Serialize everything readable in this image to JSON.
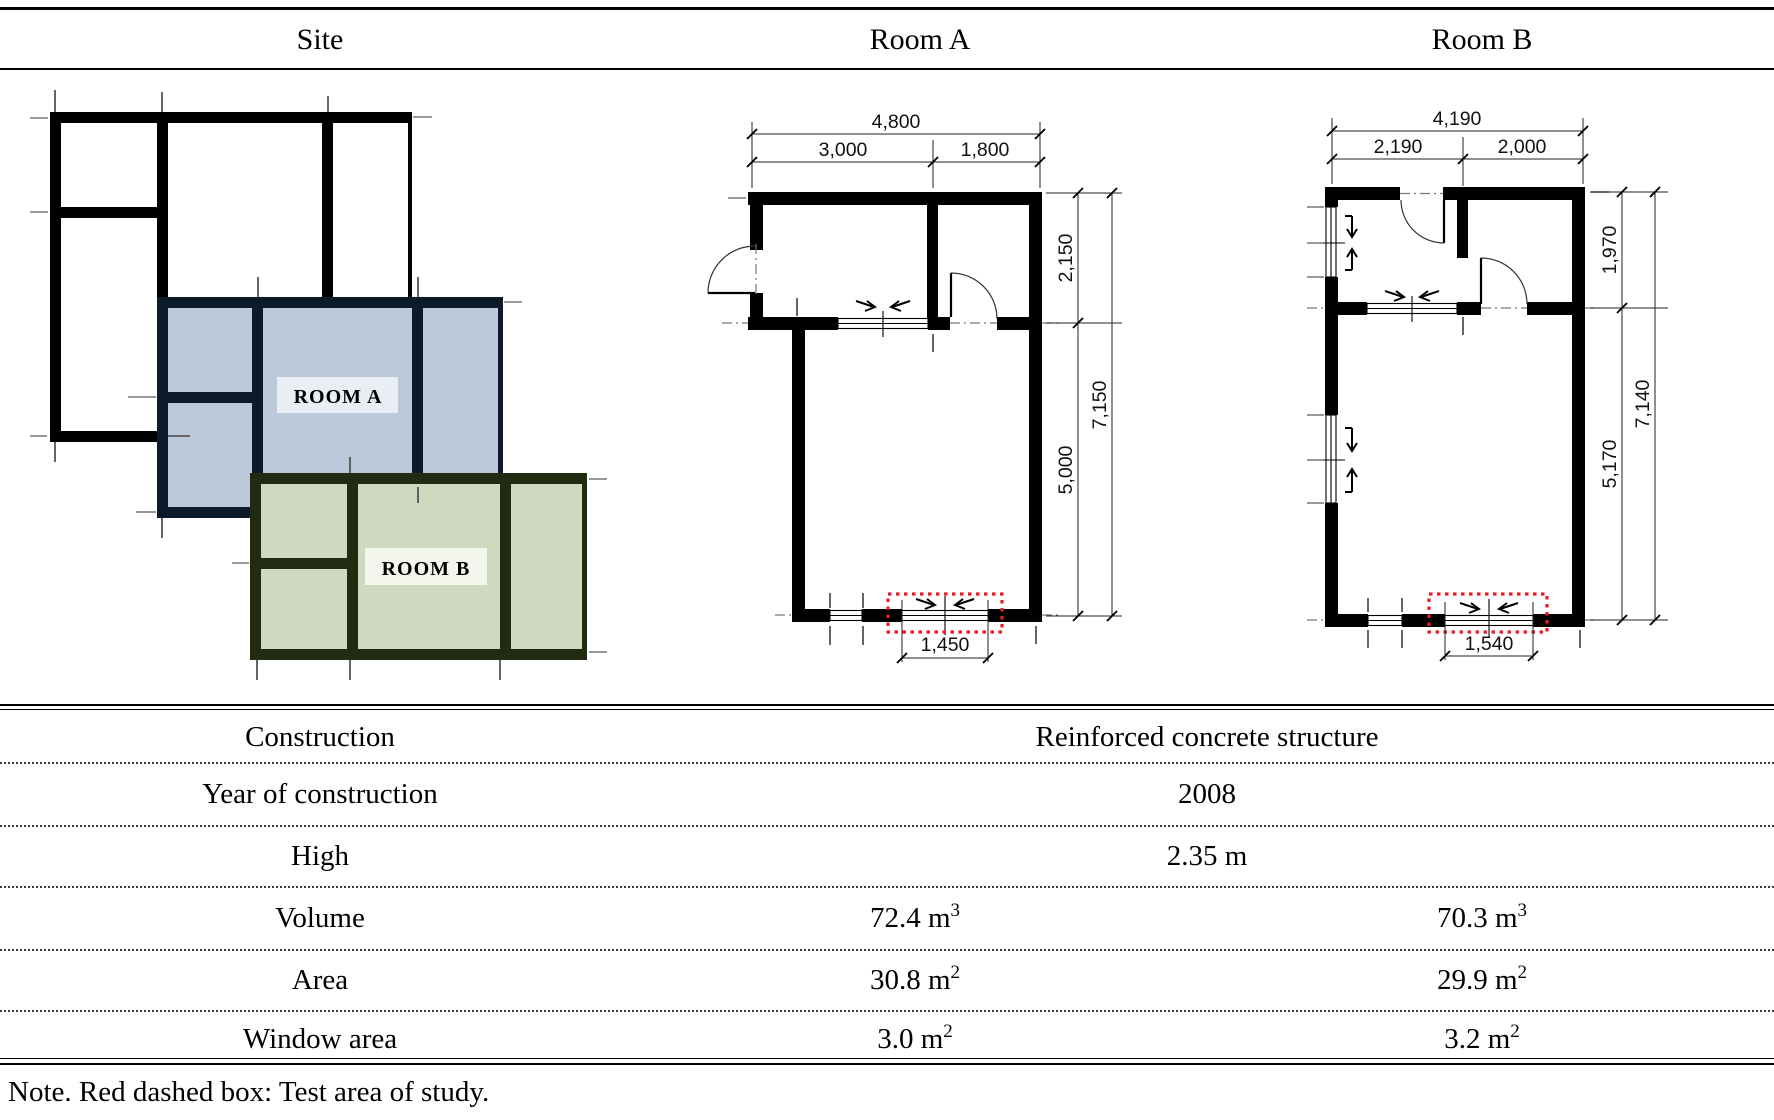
{
  "header": {
    "site": "Site",
    "room_a": "Room A",
    "room_b": "Room B"
  },
  "site_plan": {
    "room_a_label": "ROOM A",
    "room_b_label": "ROOM B",
    "room_a_fill": "#bcc9da",
    "room_a_wall": "#0d1a29",
    "room_b_fill": "#cfd9bf",
    "room_b_wall": "#202b11"
  },
  "room_a_plan": {
    "dims": {
      "total_width": "4,800",
      "left_width": "3,000",
      "right_width": "1,800",
      "upper_height": "2,150",
      "lower_height": "5,000",
      "total_height": "7,150",
      "window_width": "1,450"
    }
  },
  "room_b_plan": {
    "dims": {
      "total_width": "4,190",
      "left_width": "2,190",
      "right_width": "2,000",
      "upper_height": "1,970",
      "lower_height": "5,170",
      "total_height": "7,140",
      "window_width": "1,540"
    }
  },
  "table": {
    "rows": [
      {
        "label": "Construction",
        "span": "Reinforced concrete structure"
      },
      {
        "label": "Year of construction",
        "span": "2008"
      },
      {
        "label": "High",
        "span": "2.35 m"
      },
      {
        "label": "Volume",
        "a": "72.4 m",
        "a_sup": "3",
        "b": "70.3 m",
        "b_sup": "3"
      },
      {
        "label": "Area",
        "a": "30.8 m",
        "a_sup": "2",
        "b": "29.9 m",
        "b_sup": "2"
      },
      {
        "label": "Window area",
        "a": "3.0 m",
        "a_sup": "2",
        "b": "3.2 m",
        "b_sup": "2"
      }
    ]
  },
  "note": "Note. Red dashed box: Test area of study.",
  "accent_red": "#ec1c24"
}
